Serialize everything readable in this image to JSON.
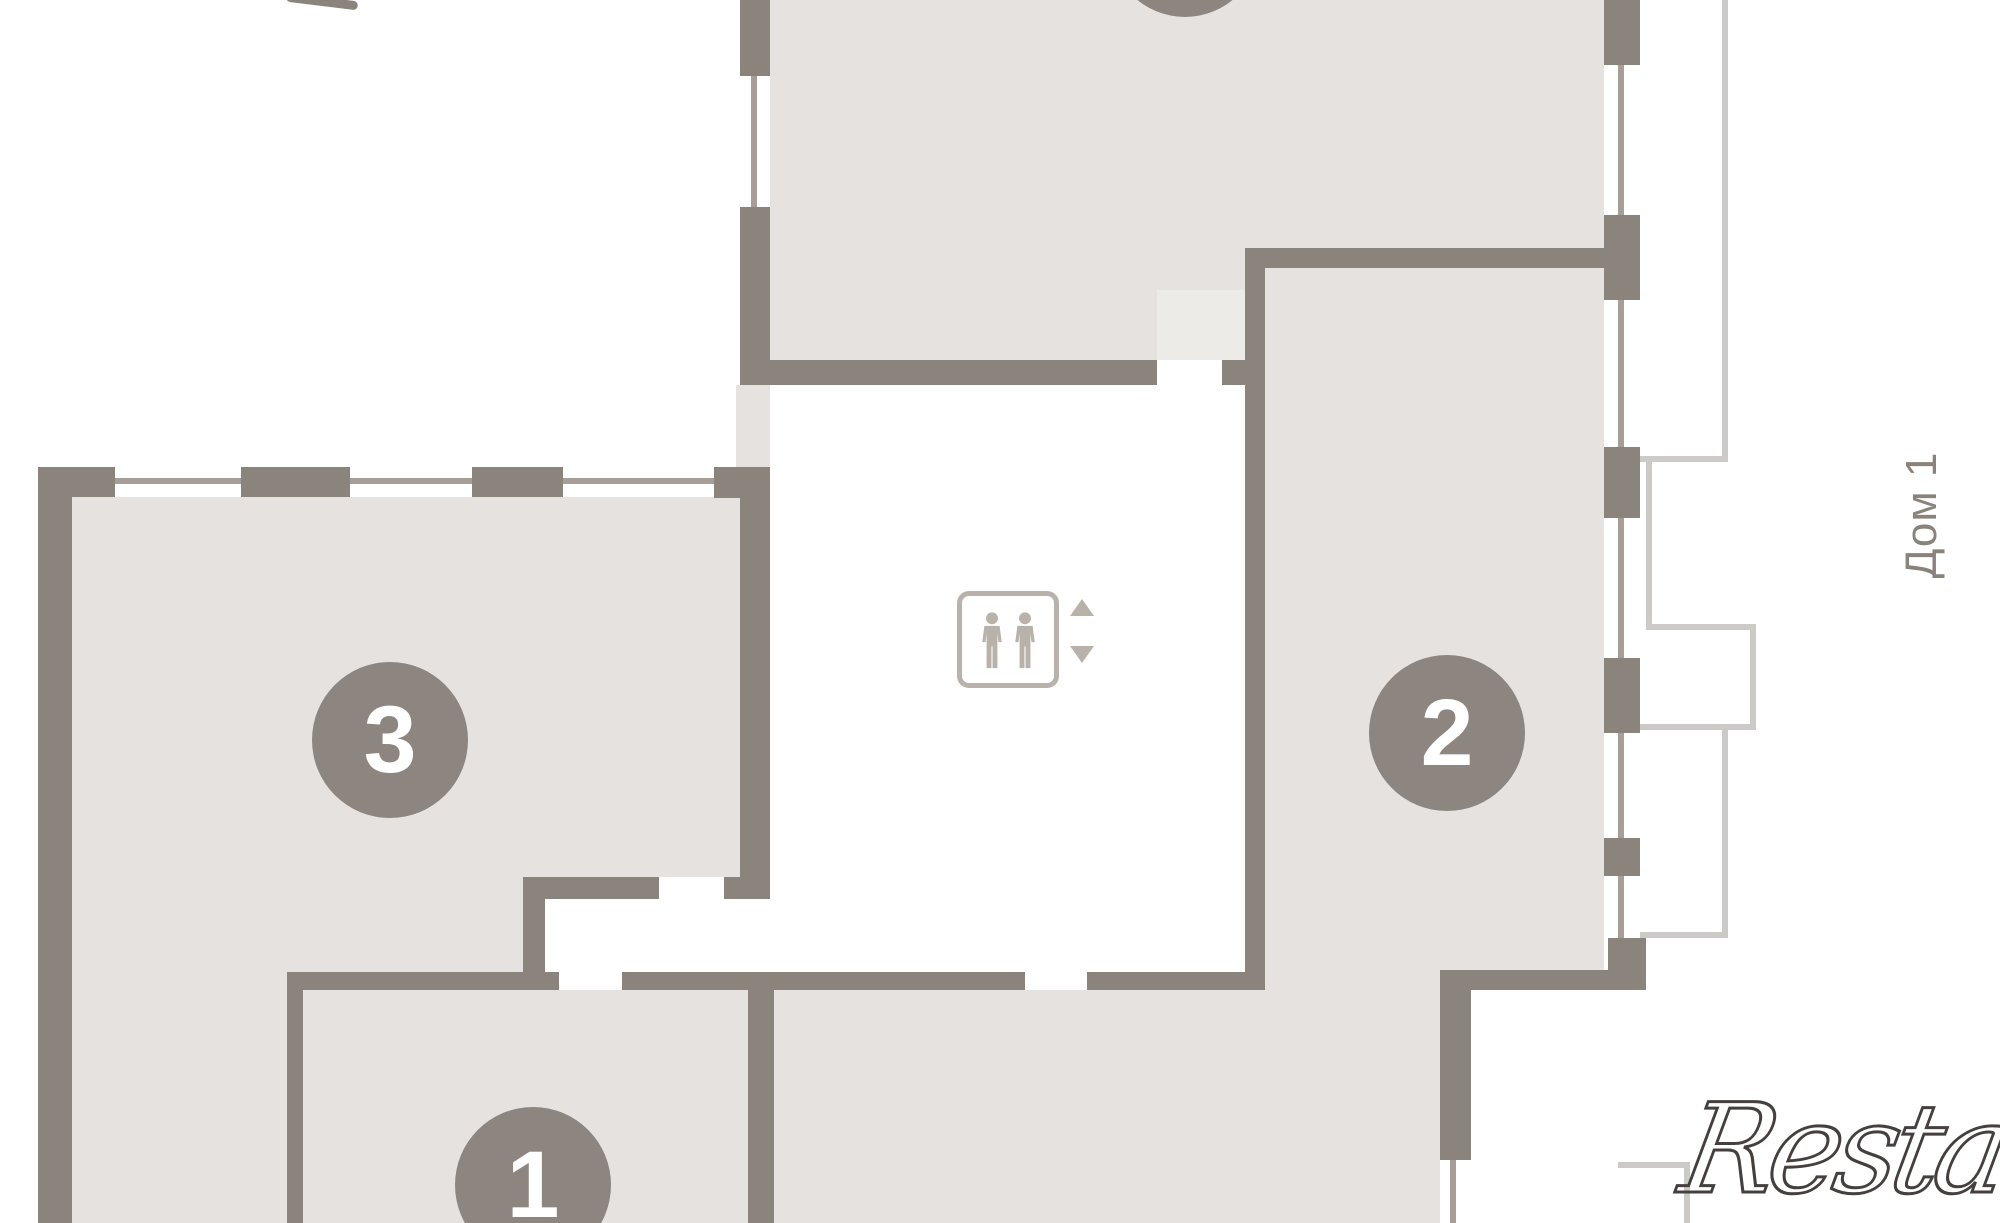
{
  "palette": {
    "wall": "#8b847c",
    "room_fill": "#e5e2df",
    "door_fill": "#edebe8",
    "badge": "#8d8680",
    "window_line": "#a79f97",
    "balcony_line": "#cccac6",
    "icon": "#b8b2ab",
    "label": "#8a837b",
    "watermark": "#45403e"
  },
  "plan": {
    "building_label": "Дом 1",
    "unit_badges": [
      {
        "label": "3",
        "cx": 390,
        "cy": 740,
        "r": 78
      },
      {
        "label": "2",
        "cx": 1447,
        "cy": 733,
        "r": 78
      },
      {
        "label": "1",
        "cx": 533,
        "cy": 1185,
        "r": 78
      },
      {
        "label": "",
        "cx": 1185,
        "cy": -58,
        "r": 75
      }
    ],
    "elevator": {
      "icon": "elevator-people-icon",
      "up_icon": "triangle-up-icon",
      "down_icon": "triangle-down-icon"
    },
    "room_fills": [
      {
        "name": "top-room-fill-left",
        "x": 770,
        "y": 0,
        "w": 475,
        "h": 360
      },
      {
        "name": "top-room-fill-right",
        "x": 1245,
        "y": 0,
        "w": 359,
        "h": 248
      },
      {
        "name": "unit2-room-fill",
        "x": 1265,
        "y": 268,
        "w": 339,
        "h": 702
      },
      {
        "name": "unit2-opening-fill",
        "x": 1257,
        "y": 970,
        "w": 183,
        "h": 20
      },
      {
        "name": "bottom-middle-room-fill",
        "x": 774,
        "y": 990,
        "w": 666,
        "h": 233
      },
      {
        "name": "unit3-room-fill",
        "x": 72,
        "y": 497,
        "w": 668,
        "h": 380
      },
      {
        "name": "unit3-lower-fill",
        "x": 72,
        "y": 877,
        "w": 451,
        "h": 95
      },
      {
        "name": "unit3-bottom-left-fill",
        "x": 72,
        "y": 972,
        "w": 215,
        "h": 251
      },
      {
        "name": "unit1-room-fill",
        "x": 303,
        "y": 990,
        "w": 452,
        "h": 233
      },
      {
        "name": "wall-shaft-fill",
        "x": 736,
        "y": 385,
        "w": 34,
        "h": 82
      },
      {
        "name": "door-area-fill",
        "x": 1157,
        "y": 290,
        "w": 88,
        "h": 70,
        "c": "door_fill"
      }
    ],
    "window_lines": [
      {
        "name": "unit3-top-window",
        "x": 72,
        "y": 478,
        "w": 642,
        "h": 6
      },
      {
        "name": "top-room-left-window",
        "x": 751,
        "y": 76,
        "w": 6,
        "h": 131
      },
      {
        "name": "right-window-1",
        "x": 1618,
        "y": 65,
        "w": 6,
        "h": 150
      },
      {
        "name": "right-window-2",
        "x": 1618,
        "y": 300,
        "w": 6,
        "h": 147
      },
      {
        "name": "right-window-3",
        "x": 1618,
        "y": 518,
        "w": 6,
        "h": 140
      },
      {
        "name": "right-window-4",
        "x": 1618,
        "y": 733,
        "w": 6,
        "h": 105
      },
      {
        "name": "right-window-5",
        "x": 1618,
        "y": 876,
        "w": 6,
        "h": 62
      },
      {
        "name": "bottom-right-window",
        "x": 1450,
        "y": 1160,
        "w": 6,
        "h": 63
      }
    ],
    "walls": [
      {
        "name": "left-outer-wall",
        "x": 38,
        "y": 467,
        "w": 34,
        "h": 756
      },
      {
        "name": "unit3-pier-1",
        "x": 38,
        "y": 467,
        "w": 77,
        "h": 30
      },
      {
        "name": "unit3-pier-2",
        "x": 241,
        "y": 467,
        "w": 109,
        "h": 30
      },
      {
        "name": "unit3-pier-3",
        "x": 472,
        "y": 467,
        "w": 91,
        "h": 30
      },
      {
        "name": "unit3-pier-4",
        "x": 714,
        "y": 467,
        "w": 56,
        "h": 31
      },
      {
        "name": "top-room-left-wall-upper",
        "x": 740,
        "y": 0,
        "w": 30,
        "h": 76
      },
      {
        "name": "top-room-left-wall-lower",
        "x": 740,
        "y": 207,
        "w": 30,
        "h": 178
      },
      {
        "name": "unit3-corridor-wall",
        "x": 740,
        "y": 498,
        "w": 30,
        "h": 379
      },
      {
        "name": "corridor-stub-wall",
        "x": 724,
        "y": 877,
        "w": 46,
        "h": 22
      },
      {
        "name": "unit3-inner-wall-h",
        "x": 523,
        "y": 877,
        "w": 136,
        "h": 22
      },
      {
        "name": "unit3-inner-wall-v",
        "x": 523,
        "y": 899,
        "w": 22,
        "h": 91
      },
      {
        "name": "long-wall-seg-1",
        "x": 287,
        "y": 972,
        "w": 272,
        "h": 18
      },
      {
        "name": "long-wall-seg-2",
        "x": 622,
        "y": 972,
        "w": 403,
        "h": 18
      },
      {
        "name": "long-wall-seg-3",
        "x": 1087,
        "y": 972,
        "w": 170,
        "h": 18
      },
      {
        "name": "unit1-left-wall",
        "x": 287,
        "y": 990,
        "w": 16,
        "h": 233
      },
      {
        "name": "unit1-divider-wall",
        "x": 748,
        "y": 990,
        "w": 26,
        "h": 233
      },
      {
        "name": "top-room-bottom-wall",
        "x": 742,
        "y": 360,
        "w": 415,
        "h": 25
      },
      {
        "name": "top-room-bottom-stub",
        "x": 1222,
        "y": 360,
        "w": 23,
        "h": 25
      },
      {
        "name": "unit2-left-wall",
        "x": 1245,
        "y": 248,
        "w": 20,
        "h": 742
      },
      {
        "name": "unit2-top-wall",
        "x": 1245,
        "y": 248,
        "w": 359,
        "h": 20
      },
      {
        "name": "unit2-bottom-wall",
        "x": 1440,
        "y": 970,
        "w": 206,
        "h": 20
      },
      {
        "name": "corner-block",
        "x": 1608,
        "y": 938,
        "w": 38,
        "h": 36
      },
      {
        "name": "bottom-right-wall",
        "x": 1440,
        "y": 990,
        "w": 31,
        "h": 170
      },
      {
        "name": "right-pier-1",
        "x": 1604,
        "y": 0,
        "w": 36,
        "h": 65
      },
      {
        "name": "right-pier-2",
        "x": 1604,
        "y": 215,
        "w": 36,
        "h": 85
      },
      {
        "name": "right-pier-3",
        "x": 1604,
        "y": 447,
        "w": 36,
        "h": 71
      },
      {
        "name": "right-pier-4",
        "x": 1604,
        "y": 658,
        "w": 36,
        "h": 75
      },
      {
        "name": "right-pier-5",
        "x": 1604,
        "y": 838,
        "w": 36,
        "h": 38
      }
    ],
    "balcony_lines": [
      {
        "name": "balcony-edge-1",
        "x": 1722,
        "y": 0,
        "w": 6,
        "h": 462
      },
      {
        "name": "balcony-edge-2",
        "x": 1640,
        "y": 456,
        "w": 88,
        "h": 6
      },
      {
        "name": "balcony-edge-3",
        "x": 1646,
        "y": 456,
        "w": 6,
        "h": 174
      },
      {
        "name": "balcony-edge-4",
        "x": 1646,
        "y": 624,
        "w": 110,
        "h": 6
      },
      {
        "name": "balcony-edge-5",
        "x": 1750,
        "y": 624,
        "w": 6,
        "h": 106
      },
      {
        "name": "balcony-edge-6",
        "x": 1640,
        "y": 724,
        "w": 116,
        "h": 6
      },
      {
        "name": "balcony-edge-7",
        "x": 1722,
        "y": 724,
        "w": 6,
        "h": 214
      },
      {
        "name": "balcony-edge-8",
        "x": 1640,
        "y": 932,
        "w": 88,
        "h": 6
      },
      {
        "name": "balcony-edge-9",
        "x": 1618,
        "y": 1162,
        "w": 72,
        "h": 6
      },
      {
        "name": "balcony-edge-10",
        "x": 1684,
        "y": 1162,
        "w": 6,
        "h": 61
      }
    ]
  },
  "watermark": {
    "text": "Restate"
  }
}
